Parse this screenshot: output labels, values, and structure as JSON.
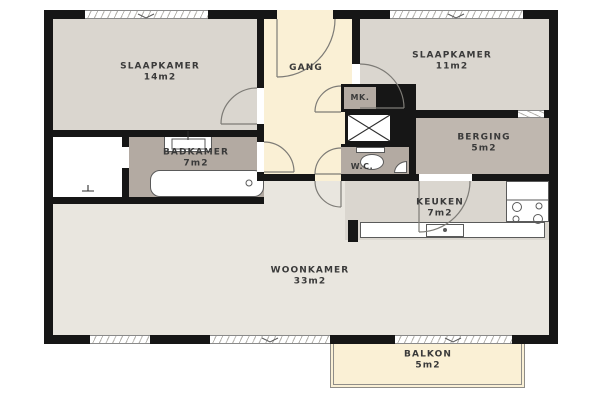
{
  "plan_title": "apartment-floor-plan",
  "rooms": {
    "slaapkamer14": {
      "name": "SLAAPKAMER",
      "area": "14m2"
    },
    "slaapkamer11": {
      "name": "SLAAPKAMER",
      "area": "11m2"
    },
    "gang": {
      "name": "GANG"
    },
    "badkamer": {
      "name": "BADKAMER",
      "area": "7m2"
    },
    "meterkast": {
      "name": "MK."
    },
    "wc": {
      "name": "W.C."
    },
    "berging": {
      "name": "BERGING",
      "area": "5m2"
    },
    "keuken": {
      "name": "KEUKEN",
      "area": "7m2"
    },
    "woonkamer": {
      "name": "WOONKAMER",
      "area": "33m2"
    },
    "balkon": {
      "name": "BALKON",
      "area": "5m2"
    }
  },
  "colors": {
    "wall": "#161616",
    "bedroom_floor": "#dad6cf",
    "living_floor": "#e9e6df",
    "hall_floor": "#faf0d5",
    "bathroom_floor": "#b3aaa2",
    "storage_floor": "#bfb7af",
    "fixture_white": "#ffffff",
    "label_text": "#3a3a3a"
  }
}
